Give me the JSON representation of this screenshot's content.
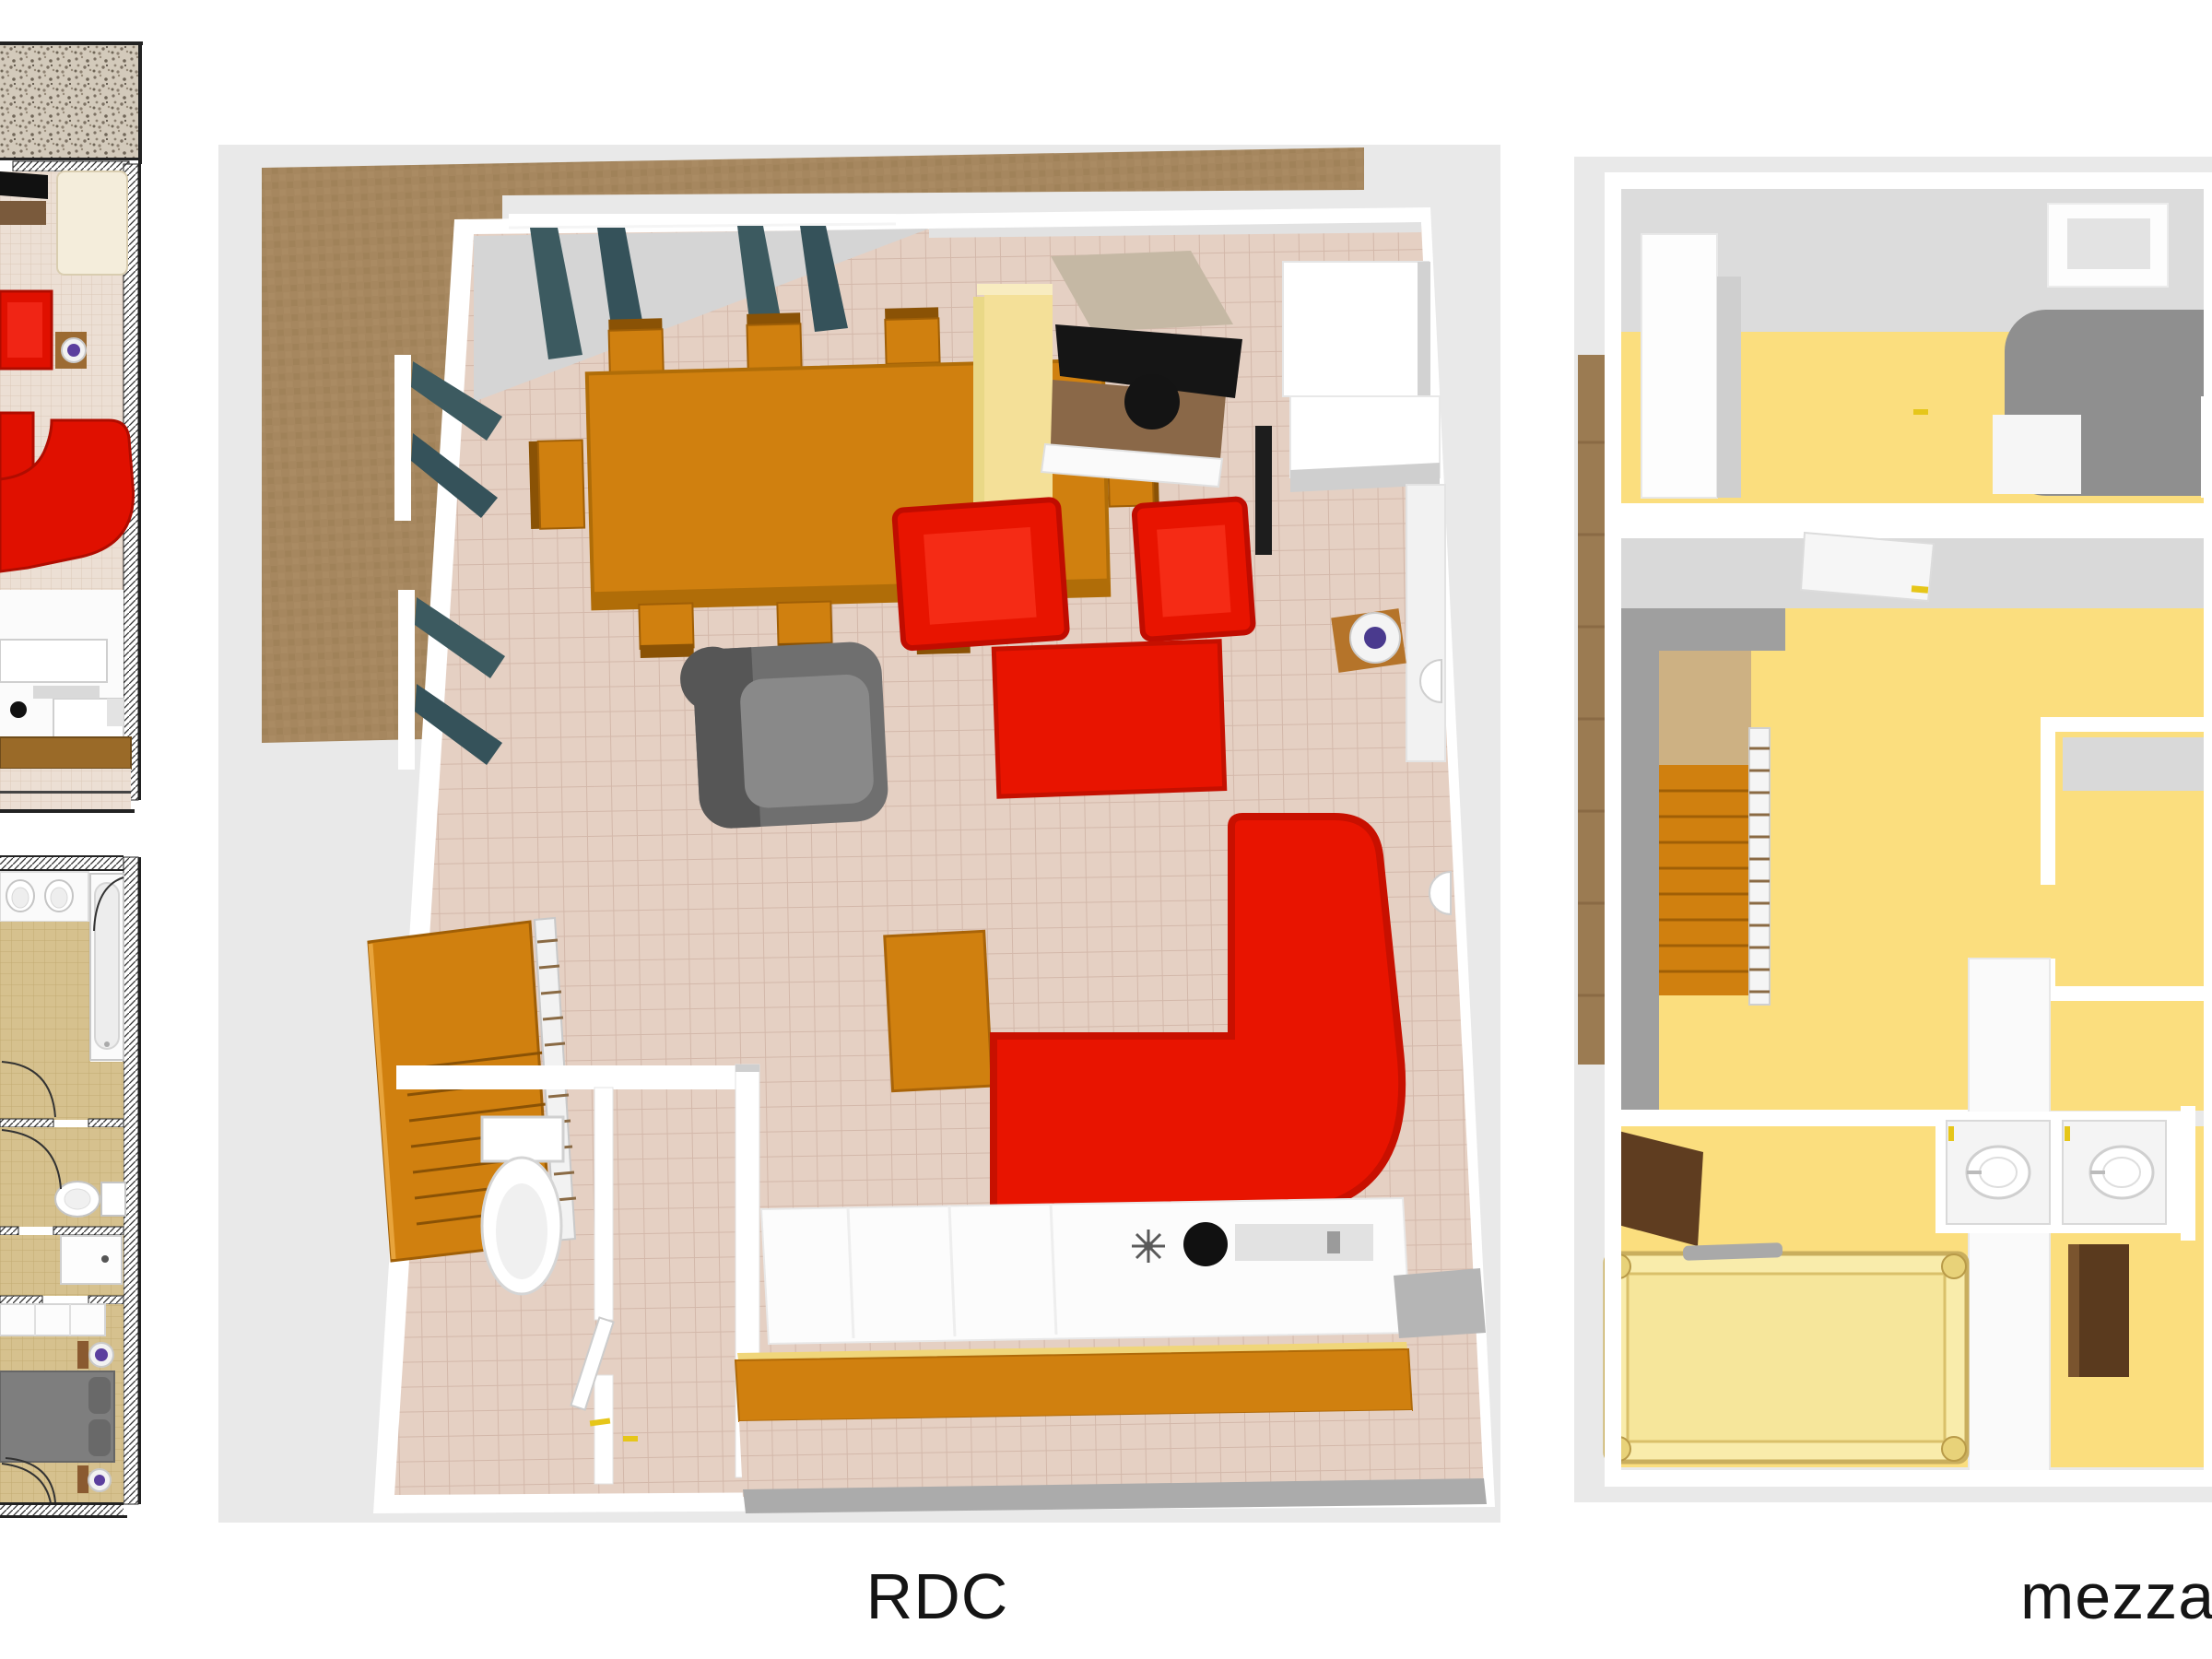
{
  "sheet": {
    "type": "floor-plan-sheet",
    "background": "#ffffff"
  },
  "floors": [
    {
      "id": "rdc",
      "label": "RDC",
      "view": "3d-top-down",
      "items": [
        "terrace",
        "dining-table",
        "dining-chairs",
        "curtained-windows",
        "yellow-cabinet",
        "tv-on-stand",
        "kitchen-cabinets",
        "red-armchairs",
        "red-coffee-table",
        "red-corner-sofa",
        "gray-armchair",
        "globe-side-table",
        "staircase",
        "wc-room-with-toilet",
        "kitchen-counter-with-sink-and-burner",
        "outdoor-bench"
      ]
    },
    {
      "id": "mezzanine",
      "label": "mezzanine",
      "view": "3d-top-down",
      "items": [
        "wardrobe",
        "skylight",
        "gray-bed",
        "stairwell-void",
        "staircase",
        "railing-ladder",
        "open-doors",
        "double-bed-yellow",
        "two-wc-closets",
        "brown-cabinet"
      ]
    }
  ],
  "thumbnails": [
    {
      "id": "ground-floor-2d",
      "description": "cropped 2D plan: gravel terrace, living room with red sofas and TV, kitchen, wooden deck"
    },
    {
      "id": "upper-floor-2d",
      "description": "cropped 2D plan: bathroom with tub and twin sinks, WC, shower room, bedroom with gray bed"
    }
  ],
  "palette": {
    "canvas_gray": "#e9e9e9",
    "terrace_brown": "#a6875f",
    "wood_strip_brown": "#9b7b52",
    "wall_white": "#ffffff",
    "wall_face_gray": "#d5d5d5",
    "tile_floor": "#e5d0c3",
    "sofa_red": "#e81400",
    "furniture_orange": "#d0800f",
    "curtain_teal": "#3c5a60",
    "cabinet_yellow": "#f4e098",
    "mezzanine_floor_yellow": "#fbde7e",
    "bed_gray": "#8f8f8f",
    "yellow_bed": "#f9ecab",
    "thumb_khaki": "#d6c18e",
    "deck_brown": "#9a6a28",
    "door_brown": "#5f3d20",
    "lamp_purple": "#5b3f9e",
    "label_text": "#151515"
  }
}
